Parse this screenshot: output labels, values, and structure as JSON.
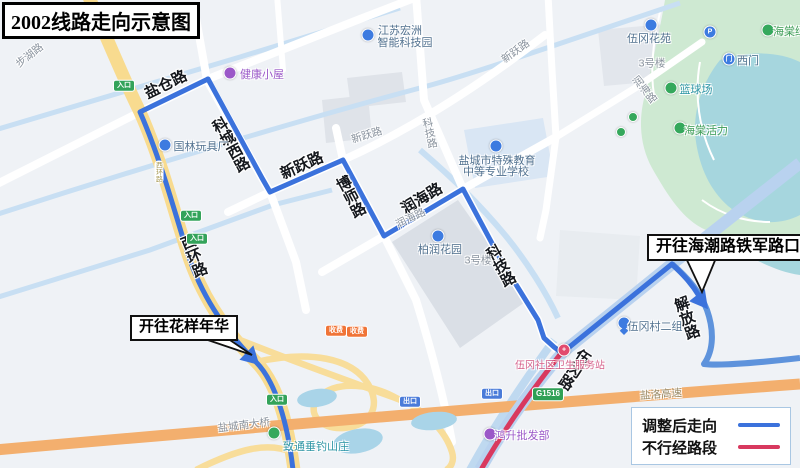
{
  "title": "2002线路走向示意图",
  "callouts": {
    "left": "开往花样年华",
    "right": "开往海潮路铁军路口"
  },
  "legend": {
    "items": [
      {
        "label": "调整后走向",
        "color": "#3B72DC"
      },
      {
        "label": "不行经路段",
        "color": "#D8395F"
      }
    ]
  },
  "roads": {
    "yancang": "盐仓路",
    "kechengxi": "科城西路",
    "xinyue": "新跃路",
    "boshi": "博师路",
    "runhai": "润海路",
    "keji": "科技路",
    "xihuan": "西环路",
    "wugang": "伍冈路",
    "jiefang": "解放路"
  },
  "small_labels": {
    "buhu": "步湖路",
    "xinyue": "新跃路",
    "keji": "科技路",
    "runhai": "润海路",
    "floor3": "3号楼",
    "bridge": "盐城南大桥",
    "expressway": "盐洛高速",
    "xihuan": "西环路"
  },
  "pois": {
    "jiankang": "健康小屋",
    "hongzhou_l1": "江苏宏洲",
    "hongzhou_l2": "智能科技园",
    "guolin": "国林玩具厂",
    "school_l1": "盐城市特殊教育",
    "school_l2": "中等专业学校",
    "bairun": "柏润花园",
    "wugang_estate": "伍冈花苑",
    "ximen": "西门",
    "haitang_island": "海棠绿岛",
    "basketball": "篮球场",
    "haitang_vitality": "海棠活力",
    "wugang_village": "伍冈村二组",
    "clinic": "伍冈社区卫生服务站",
    "wholesale": "鸿升批发部",
    "fishing": "致通垂钓山庄",
    "parking": "P",
    "gate_glyph": "门",
    "cross_glyph": "+"
  },
  "badges": {
    "entrance": "入口",
    "exit": "出口",
    "toll": "收费",
    "highway_no": "G1516"
  },
  "colors": {
    "route_blue": "#3B72DC",
    "skip_pink": "#D8395F",
    "road_yellow": "#F8DB8F",
    "highway_orange": "#F3AF6E",
    "water": "#A6D6DE",
    "park": "#CEE9D2"
  }
}
